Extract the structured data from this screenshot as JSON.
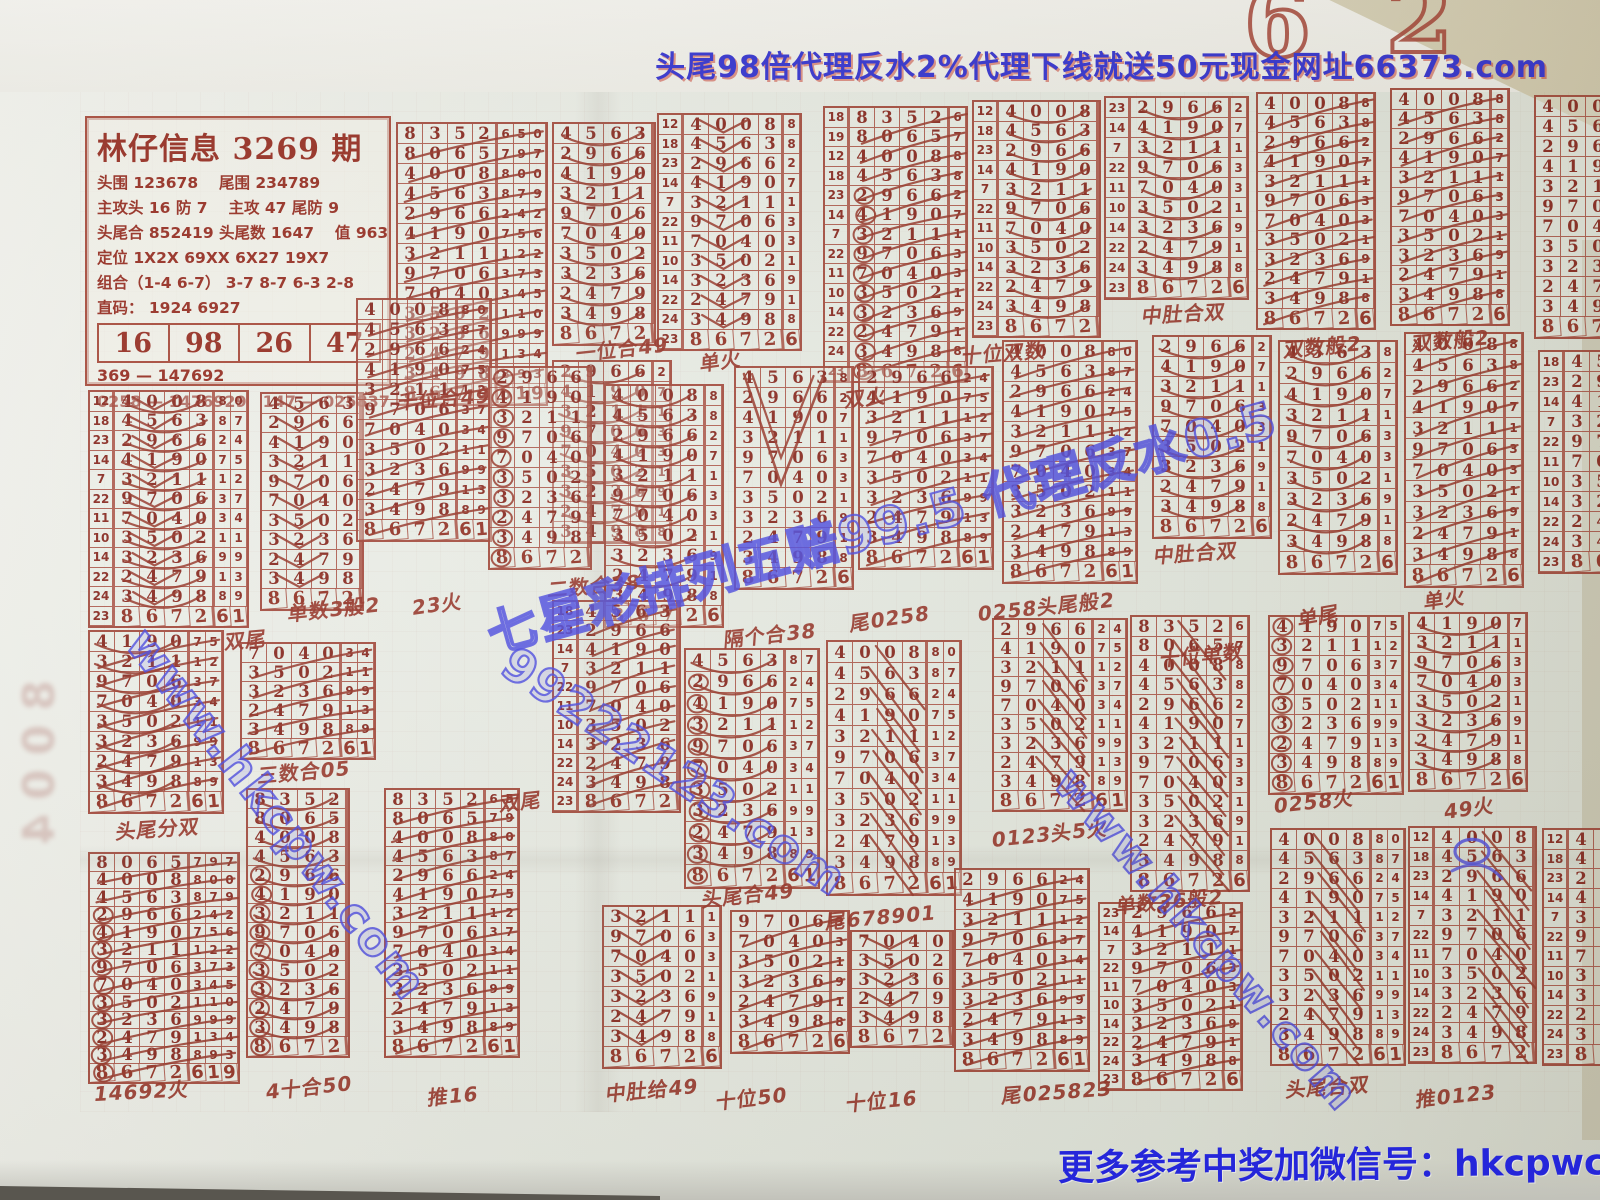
{
  "colors": {
    "ink": "#7e150c",
    "line": "#9e3628",
    "blue": "#2525da",
    "mark": "#8d2316",
    "bluepen": "#3c3ce6"
  },
  "banner": {
    "text": "头尾98倍代理反水2%代理下线就送50元现金网址66373.com"
  },
  "wechat_note": {
    "text": "更多参考中奖加微信号：hkcpwcn"
  },
  "top_scrap": {
    "digit1": "6",
    "digit2": "2"
  },
  "ghost_text": "8004",
  "info_box": {
    "title": "林仔信息 3269 期",
    "lines": [
      "头围 123678　 尾围 234789",
      "主攻头 16 防 7 　主攻 47 尾防 9",
      "头尾合 852419  头尾数 1647 　值 963",
      "定位 1X2X  69XX  6X27  19X7",
      "组合（1-4 6-7） 3-7  8-7  6-3  2-8",
      "直码： 1924  6927"
    ],
    "table": [
      "16",
      "98",
      "26",
      "47"
    ],
    "footer": [
      "369 — 147692",
      "0258 — 1476929　147 — 025837"
    ]
  },
  "master_rows": [
    {
      "s": "18",
      "d": "8352",
      "e": "650"
    },
    {
      "s": "19",
      "d": "8065",
      "e": "797"
    },
    {
      "s": "12",
      "d": "4008",
      "e": "800"
    },
    {
      "s": "18",
      "d": "4563",
      "e": "879"
    },
    {
      "s": "23",
      "d": "2966",
      "e": "242"
    },
    {
      "s": "14",
      "d": "4190",
      "e": "756"
    },
    {
      "s": "7",
      "d": "3211",
      "e": "122"
    },
    {
      "s": "22",
      "d": "9706",
      "e": "373"
    },
    {
      "s": "11",
      "d": "7040",
      "e": "345"
    },
    {
      "s": "10",
      "d": "3502",
      "e": "110"
    },
    {
      "s": "14",
      "d": "3236",
      "e": "999"
    },
    {
      "s": "22",
      "d": "2479",
      "e": "134"
    },
    {
      "s": "24",
      "d": "3498",
      "e": "893"
    },
    {
      "s": "23",
      "d": "8672",
      "e": "619"
    }
  ],
  "grids": [
    {
      "x": 396,
      "y": 122,
      "f": 0,
      "t": 13,
      "su": 0,
      "ex": 3,
      "rh": 20,
      "mk": [
        "slash"
      ]
    },
    {
      "x": 552,
      "y": 122,
      "f": 3,
      "t": 13,
      "su": 0,
      "ex": 0,
      "rh": 20,
      "mk": [
        "arcs"
      ]
    },
    {
      "x": 552,
      "y": 360,
      "f": 4,
      "t": 12,
      "su": 0,
      "ex": 1,
      "rh": 20,
      "mk": [
        "arcs"
      ]
    },
    {
      "x": 657,
      "y": 113,
      "f": 2,
      "t": 13,
      "su": 1,
      "ex": 1,
      "rh": 19.5,
      "mk": [
        "vee"
      ]
    },
    {
      "x": 823,
      "y": 106,
      "f": 0,
      "t": 13,
      "su": 1,
      "ex": 1,
      "rh": 19.5,
      "mk": [
        "circles",
        "slash"
      ]
    },
    {
      "x": 972,
      "y": 100,
      "f": 2,
      "t": 13,
      "su": 1,
      "ex": 0,
      "rh": 19.5,
      "mk": [
        "arcs"
      ]
    },
    {
      "x": 1104,
      "y": 96,
      "f": 4,
      "t": 13,
      "su": 1,
      "ex": 1,
      "rh": 20,
      "mk": [
        "arcs"
      ]
    },
    {
      "x": 1256,
      "y": 92,
      "f": 2,
      "t": 13,
      "su": 0,
      "ex": 1,
      "rh": 19.5,
      "mk": [
        "slash"
      ]
    },
    {
      "x": 1390,
      "y": 88,
      "f": 2,
      "t": 13,
      "su": 0,
      "ex": 1,
      "rh": 19.5,
      "mk": [
        "slash"
      ]
    },
    {
      "x": 1534,
      "y": 95,
      "f": 2,
      "t": 13,
      "su": 0,
      "ex": 0,
      "rh": 20,
      "mk": []
    },
    {
      "x": 88,
      "y": 390,
      "f": 2,
      "t": 13,
      "su": 1,
      "ex": 2,
      "rh": 19.5,
      "mk": [
        "vee",
        "arcs"
      ]
    },
    {
      "x": 260,
      "y": 392,
      "f": 3,
      "t": 13,
      "su": 0,
      "ex": 0,
      "rh": 19.5,
      "mk": [
        "vee"
      ]
    },
    {
      "x": 356,
      "y": 298,
      "f": 2,
      "t": 13,
      "su": 0,
      "ex": 2,
      "rh": 20,
      "mk": [
        "slash"
      ]
    },
    {
      "x": 488,
      "y": 366,
      "f": 4,
      "t": 13,
      "su": 0,
      "ex": 0,
      "rh": 20,
      "mk": [
        "circlesLeft"
      ]
    },
    {
      "x": 604,
      "y": 384,
      "f": 2,
      "t": 13,
      "su": 0,
      "ex": 1,
      "rh": 20,
      "mk": [
        "arcs"
      ]
    },
    {
      "x": 734,
      "y": 366,
      "f": 3,
      "t": 13,
      "su": 0,
      "ex": 1,
      "rh": 20,
      "mk": [
        "bigv"
      ]
    },
    {
      "x": 858,
      "y": 366,
      "f": 4,
      "t": 13,
      "su": 0,
      "ex": 2,
      "rh": 20,
      "mk": [
        "slash"
      ]
    },
    {
      "x": 1002,
      "y": 340,
      "f": 2,
      "t": 13,
      "su": 0,
      "ex": 2,
      "rh": 20,
      "mk": [
        "slash"
      ]
    },
    {
      "x": 1152,
      "y": 335,
      "f": 4,
      "t": 13,
      "su": 0,
      "ex": 1,
      "rh": 20,
      "mk": [
        "arcs"
      ]
    },
    {
      "x": 1278,
      "y": 340,
      "f": 3,
      "t": 13,
      "su": 0,
      "ex": 1,
      "rh": 21,
      "mk": [
        "arcs"
      ]
    },
    {
      "x": 1404,
      "y": 332,
      "f": 2,
      "t": 13,
      "su": 0,
      "ex": 1,
      "rh": 21,
      "mk": [
        "slash"
      ]
    },
    {
      "x": 1538,
      "y": 350,
      "f": 3,
      "t": 13,
      "su": 1,
      "ex": 0,
      "rh": 20,
      "mk": []
    },
    {
      "x": 88,
      "y": 630,
      "f": 5,
      "t": 13,
      "su": 0,
      "ex": 2,
      "rh": 20,
      "mk": [
        "slash",
        "arcs"
      ]
    },
    {
      "x": 240,
      "y": 642,
      "f": 8,
      "t": 13,
      "su": 0,
      "ex": 2,
      "rh": 19,
      "mk": [
        "slash"
      ]
    },
    {
      "x": 552,
      "y": 600,
      "f": 3,
      "t": 13,
      "su": 1,
      "ex": 0,
      "rh": 19,
      "mk": [
        "slash"
      ]
    },
    {
      "x": 684,
      "y": 648,
      "f": 3,
      "t": 13,
      "su": 0,
      "ex": 2,
      "rh": 21.5,
      "mk": [
        "circlesLeft",
        "arcs"
      ]
    },
    {
      "x": 826,
      "y": 640,
      "f": 2,
      "t": 13,
      "su": 0,
      "ex": 2,
      "rh": 21,
      "mk": [
        "slashsteep"
      ]
    },
    {
      "x": 992,
      "y": 618,
      "f": 4,
      "t": 13,
      "su": 0,
      "ex": 2,
      "rh": 19,
      "mk": [
        "slashsteep"
      ]
    },
    {
      "x": 1130,
      "y": 615,
      "f": 0,
      "t": 13,
      "su": 0,
      "ex": 1,
      "rh": 19.5,
      "mk": [
        "slashsteep"
      ]
    },
    {
      "x": 1268,
      "y": 615,
      "f": 5,
      "t": 13,
      "su": 0,
      "ex": 2,
      "rh": 19.5,
      "mk": [
        "circlesLeft"
      ]
    },
    {
      "x": 1408,
      "y": 612,
      "f": 5,
      "t": 13,
      "su": 0,
      "ex": 1,
      "rh": 19.5,
      "mk": [
        "arcs"
      ]
    },
    {
      "x": 88,
      "y": 852,
      "f": 1,
      "t": 13,
      "su": 0,
      "ex": 3,
      "rh": 17.5,
      "mk": [
        "circlesLeft",
        "slash"
      ]
    },
    {
      "x": 246,
      "y": 788,
      "f": 0,
      "t": 13,
      "su": 0,
      "ex": 0,
      "rh": 19,
      "mk": [
        "circlesLeft",
        "arcs"
      ]
    },
    {
      "x": 384,
      "y": 788,
      "f": 0,
      "t": 13,
      "su": 0,
      "ex": 2,
      "rh": 19,
      "mk": [
        "slash"
      ]
    },
    {
      "x": 602,
      "y": 905,
      "f": 6,
      "t": 13,
      "su": 0,
      "ex": 1,
      "rh": 20,
      "mk": [
        "vee"
      ]
    },
    {
      "x": 730,
      "y": 910,
      "f": 7,
      "t": 13,
      "su": 0,
      "ex": 1,
      "rh": 20,
      "mk": [
        "slash"
      ]
    },
    {
      "x": 850,
      "y": 930,
      "f": 8,
      "t": 13,
      "su": 0,
      "ex": 0,
      "rh": 19,
      "mk": [
        "vee"
      ]
    },
    {
      "x": 954,
      "y": 868,
      "f": 4,
      "t": 13,
      "su": 0,
      "ex": 2,
      "rh": 20,
      "mk": [
        "slash"
      ]
    },
    {
      "x": 1098,
      "y": 902,
      "f": 4,
      "t": 13,
      "su": 1,
      "ex": 1,
      "rh": 18.5,
      "mk": [
        "slash"
      ]
    },
    {
      "x": 1270,
      "y": 828,
      "f": 2,
      "t": 13,
      "su": 0,
      "ex": 2,
      "rh": 19.5,
      "mk": [
        "slashsteep"
      ]
    },
    {
      "x": 1408,
      "y": 826,
      "f": 2,
      "t": 13,
      "su": 1,
      "ex": 0,
      "rh": 19.5,
      "mk": [
        "slashsteep",
        "blue"
      ]
    },
    {
      "x": 1542,
      "y": 828,
      "f": 2,
      "t": 13,
      "su": 1,
      "ex": 0,
      "rh": 19.5,
      "mk": []
    }
  ],
  "captions": [
    {
      "t": "千位合49",
      "x": 398,
      "y": 386,
      "r": -4
    },
    {
      "t": "一位合49",
      "x": 576,
      "y": 338,
      "r": -6
    },
    {
      "t": "单火",
      "x": 700,
      "y": 348,
      "r": -8
    },
    {
      "t": "双火",
      "x": 845,
      "y": 384,
      "r": -6
    },
    {
      "t": "十位双数",
      "x": 962,
      "y": 340,
      "r": -4
    },
    {
      "t": "中肚合双",
      "x": 1142,
      "y": 300,
      "r": -3
    },
    {
      "t": "双数般2",
      "x": 1284,
      "y": 334,
      "r": -5
    },
    {
      "t": "双数般2",
      "x": 1412,
      "y": 328,
      "r": -5
    },
    {
      "t": "双尾",
      "x": 225,
      "y": 626,
      "r": -5
    },
    {
      "t": "单数3般2",
      "x": 288,
      "y": 598,
      "r": -6
    },
    {
      "t": "23火",
      "x": 412,
      "y": 592,
      "r": -8
    },
    {
      "t": "二数合38",
      "x": 548,
      "y": 574,
      "r": -5
    },
    {
      "t": "隔个合38",
      "x": 724,
      "y": 624,
      "r": -6
    },
    {
      "t": "尾0258",
      "x": 850,
      "y": 608,
      "r": -8
    },
    {
      "t": "0258头尾般2",
      "x": 978,
      "y": 598,
      "r": -6
    },
    {
      "t": "中肚合双",
      "x": 1154,
      "y": 540,
      "r": -4
    },
    {
      "t": "十位单数",
      "x": 1160,
      "y": 643,
      "r": -5
    },
    {
      "t": "单尾",
      "x": 1298,
      "y": 604,
      "r": -10
    },
    {
      "t": "单火",
      "x": 1424,
      "y": 586,
      "r": -8
    },
    {
      "t": "头尾分双",
      "x": 116,
      "y": 816,
      "r": -4
    },
    {
      "t": "三数合05",
      "x": 258,
      "y": 760,
      "r": -5
    },
    {
      "t": "双尾",
      "x": 500,
      "y": 788,
      "r": -6
    },
    {
      "t": "头尾合49",
      "x": 702,
      "y": 884,
      "r": -6
    },
    {
      "t": "尾678901",
      "x": 826,
      "y": 906,
      "r": -5
    },
    {
      "t": "0123头5火",
      "x": 992,
      "y": 824,
      "r": -6
    },
    {
      "t": "单数36般2",
      "x": 1116,
      "y": 890,
      "r": -5
    },
    {
      "t": "0258火",
      "x": 1274,
      "y": 790,
      "r": -6
    },
    {
      "t": "49火",
      "x": 1444,
      "y": 796,
      "r": -8
    },
    {
      "t": "14692火",
      "x": 94,
      "y": 1078,
      "r": -3
    },
    {
      "t": "4十合50",
      "x": 266,
      "y": 1076,
      "r": -6
    },
    {
      "t": "推16",
      "x": 428,
      "y": 1082,
      "r": -5
    },
    {
      "t": "中肚给49",
      "x": 606,
      "y": 1078,
      "r": -5
    },
    {
      "t": "十位50",
      "x": 716,
      "y": 1086,
      "r": -6
    },
    {
      "t": "十位16",
      "x": 846,
      "y": 1088,
      "r": -5
    },
    {
      "t": "尾025823",
      "x": 1002,
      "y": 1080,
      "r": -4
    },
    {
      "t": "头尾合双",
      "x": 1286,
      "y": 1074,
      "r": -4
    },
    {
      "t": "推0123",
      "x": 1416,
      "y": 1084,
      "r": -6
    }
  ],
  "watermarks": [
    {
      "t": "www.hkcpw.com",
      "x": 158,
      "y": 618,
      "r": 52,
      "s": 46
    },
    {
      "t": "七星彩排列五赔99.5 代理反水0.5",
      "x": 478,
      "y": 598,
      "r": -15.5,
      "s": 50
    },
    {
      "t": "99222123.com",
      "x": 522,
      "y": 636,
      "r": 34,
      "s": 46
    },
    {
      "t": "www.hkcpw.com",
      "x": 1082,
      "y": 758,
      "r": 49,
      "s": 44
    }
  ]
}
